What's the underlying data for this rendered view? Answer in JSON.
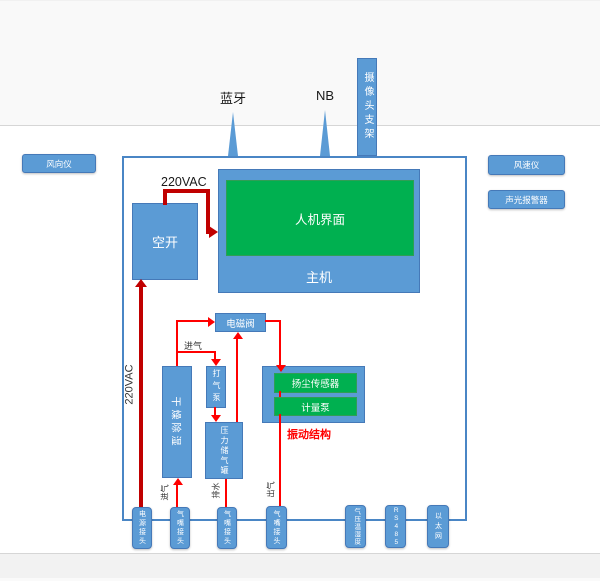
{
  "colors": {
    "blue": "#5B9BD5",
    "blue_border": "#4579B8",
    "green": "#00B050",
    "green_border": "#2F9E55",
    "red": "#FF0000",
    "dark_red": "#C00000",
    "container_border": "#4A86C5"
  },
  "antennas": {
    "bluetooth": "蓝牙",
    "nb": "NB",
    "camera_mount": "摄像头支架"
  },
  "external": {
    "wind_direction": "风向仪",
    "wind_speed": "风速仪",
    "sound_light_alarm": "声光报警器"
  },
  "power": {
    "ac_top": "220VAC",
    "ac_left": "220VAC"
  },
  "blocks": {
    "breaker": "空开",
    "hmi": "人机界面",
    "host": "主机",
    "solenoid_valve": "电磁阀",
    "dryer": "干燥除湿",
    "air_pump": "打气泵",
    "pressure_tank": "压力储气罐",
    "dust_sensor": "扬尘传感器",
    "metering_pump": "计量泵",
    "vibration_note": "振动结构"
  },
  "flow_labels": {
    "intake_mid": "进气",
    "intake_bottom": "进气",
    "drain": "排水",
    "outlet": "出气"
  },
  "connectors": [
    {
      "label": "电源接头"
    },
    {
      "label": "气嘴接头"
    },
    {
      "label": "气嘴接头"
    },
    {
      "label": "气嘴接头"
    },
    {
      "label": "气压温湿度"
    },
    {
      "label": "RS485"
    },
    {
      "label": "以太网"
    }
  ]
}
